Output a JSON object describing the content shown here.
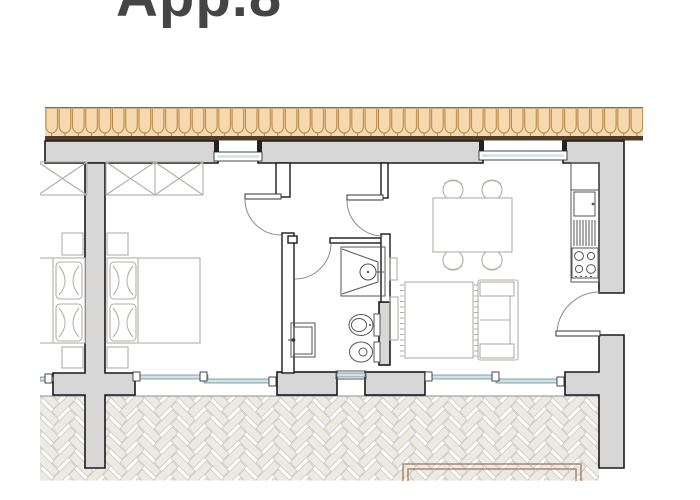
{
  "title": {
    "label": "App.8"
  },
  "colors": {
    "background": "#ffffff",
    "title_color": "#454545",
    "wall_fill": "#d7d7d7",
    "wall_outline": "#1a1a1a",
    "partition_fill": "#ffffff",
    "roof_fill": "#f6d9ae",
    "roof_line": "#b5823f",
    "roof_edge": "#4f3d2a",
    "window_glass": "#cfe2e6",
    "furniture_line": "#b3aea8",
    "fixture_line": "#555555",
    "door_arc": "#8a8a8a",
    "paving_fill": "#edeae4",
    "paving_line": "#ccc7bf",
    "planter_line": "#a5806a",
    "floor_line": "#a6a39d"
  },
  "plan": {
    "label": "apartment-floor-plan",
    "rooms": [
      {
        "name": "neighbor-unit-partial"
      },
      {
        "name": "bedroom"
      },
      {
        "name": "hallway-vestibule"
      },
      {
        "name": "bathroom"
      },
      {
        "name": "living-room-with-kitchen"
      },
      {
        "name": "terrace"
      }
    ],
    "fixtures": [
      "roof-tiles",
      "exterior-walls",
      "window",
      "sliding-window",
      "entrance-door",
      "interior-door",
      "wardrobe",
      "double-bed",
      "nightstand",
      "rug",
      "sofa",
      "tv-bench",
      "dining-table",
      "chair",
      "kitchen-counter",
      "kitchen-sink",
      "dish-drainer",
      "cooktop",
      "shower",
      "toilet",
      "bidet",
      "vanity-sink",
      "terrace-paving",
      "planter"
    ]
  }
}
